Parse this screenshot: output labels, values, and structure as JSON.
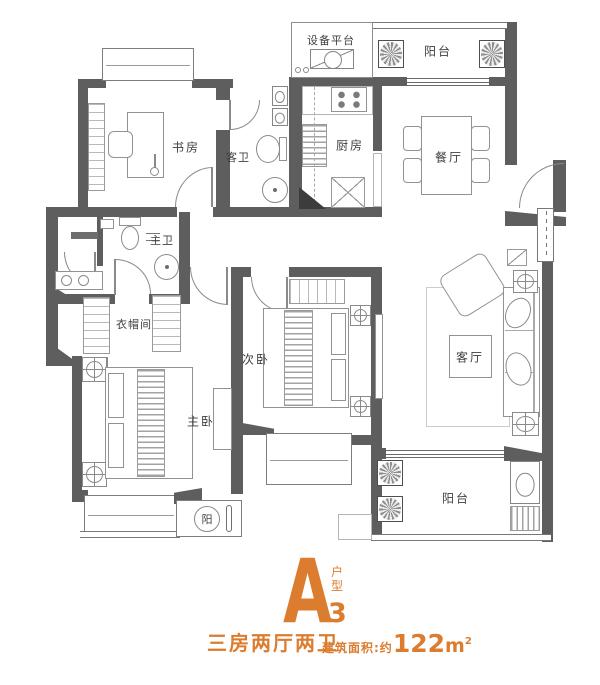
{
  "colors": {
    "accent": "#DB7C2F",
    "wall": "#5E5E5E",
    "furniture_line": "#929292",
    "label_text": "#3F3F3F",
    "background": "#FFFFFF"
  },
  "rooms": {
    "study": "书房",
    "guest_bath": "客卫",
    "equipment_platform": "设备平台",
    "balcony_top": "阳台",
    "kitchen": "厨房",
    "dining": "餐厅",
    "master_bath": "主卫",
    "cloakroom": "衣帽间",
    "second_bedroom": "次卧",
    "master_bedroom": "主卧",
    "living_room": "客厅",
    "balcony_bottom": "阳台",
    "sun_nook": "阳"
  },
  "title": {
    "plan_letter": "A",
    "plan_number": "3",
    "plan_type_label": "户型",
    "layout_name": "三房两厅两卫",
    "area_label": "建筑面积:约",
    "area_value": "122",
    "area_unit": "m",
    "area_exponent": "2"
  }
}
